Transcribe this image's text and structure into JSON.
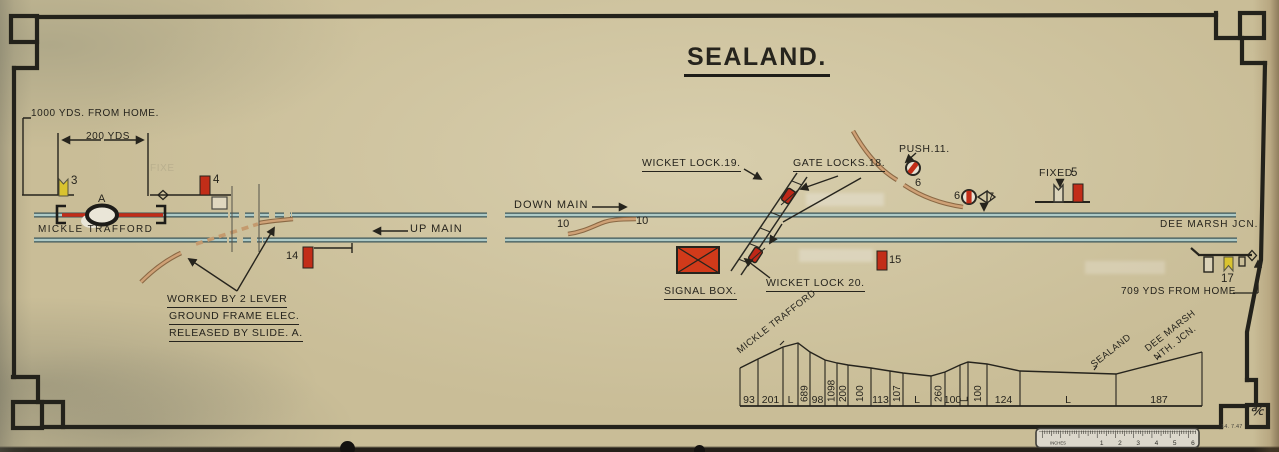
{
  "title": {
    "text": "SEALAND."
  },
  "labels": {
    "yds_1000": "1000 YDS. FROM HOME.",
    "yds_200": "200 YDS",
    "mickle_trafford": "MICKLE  TRAFFORD",
    "up_main": "UP MAIN",
    "down_main": "DOWN MAIN",
    "wicket_lock_19": "WICKET LOCK.19.",
    "gate_locks_18": "GATE LOCKS.18.",
    "push_11": "PUSH.11.",
    "fixed": "FIXED",
    "dee_marsh_jcn": "DEE  MARSH  JCN.",
    "signal_box": "SIGNAL BOX.",
    "wicket_lock_20": "WICKET LOCK 20.",
    "worked_line1": "WORKED  BY  2 LEVER",
    "worked_line2": "GROUND  FRAME  ELEC.",
    "worked_line3": "RELEASED  BY  SLIDE. A.",
    "yds_709": "709 YDS FROM  HOME",
    "ghost_fixe": "FIXE",
    "date_stamp": "14. 7.47",
    "corner_mark": "℀"
  },
  "numbers": {
    "n3": "3",
    "n4": "4",
    "n5": "5",
    "n6_curve": "6",
    "n6_disc": "6",
    "n7": "7",
    "n10_left": "10",
    "n10_right": "10",
    "n14": "14",
    "n15": "15",
    "n17": "17",
    "slide_a": "A"
  },
  "gradient_profile": {
    "baseline_y": 406,
    "boundaries": [
      [
        740,
        368
      ],
      [
        758,
        359
      ],
      [
        783,
        347
      ],
      [
        798,
        343
      ],
      [
        810,
        352
      ],
      [
        825,
        360
      ],
      [
        837,
        363
      ],
      [
        848,
        365
      ],
      [
        871,
        368
      ],
      [
        890,
        371
      ],
      [
        903,
        373
      ],
      [
        931,
        376
      ],
      [
        945,
        372
      ],
      [
        960,
        365
      ],
      [
        968,
        362
      ],
      [
        987,
        364
      ],
      [
        1020,
        371
      ],
      [
        1116,
        374
      ],
      [
        1202,
        352
      ]
    ],
    "segments": [
      {
        "label": "93",
        "vertical": false
      },
      {
        "label": "201",
        "vertical": false
      },
      {
        "label": "L",
        "vertical": false
      },
      {
        "label": "689",
        "vertical": true
      },
      {
        "label": "98",
        "vertical": false
      },
      {
        "label": "1098",
        "vertical": true
      },
      {
        "label": "200",
        "vertical": true
      },
      {
        "label": "100",
        "vertical": true
      },
      {
        "label": "113",
        "vertical": false
      },
      {
        "label": "107",
        "vertical": true
      },
      {
        "label": "L",
        "vertical": false
      },
      {
        "label": "260",
        "vertical": true
      },
      {
        "label": "100",
        "vertical": false
      },
      {
        "label": "L",
        "vertical": true
      },
      {
        "label": "100",
        "vertical": true
      },
      {
        "label": "124",
        "vertical": false
      },
      {
        "label": "L",
        "vertical": false
      },
      {
        "label": "187",
        "vertical": false
      }
    ],
    "station_labels": [
      {
        "text": "MICKLE TRAFFORD"
      },
      {
        "text": "SEALAND"
      },
      {
        "text": "DEE MARSH"
      },
      {
        "text": "NTH. JCN."
      }
    ]
  },
  "ruler": {
    "label": "INCHES",
    "numbers": [
      "1",
      "2",
      "3",
      "4",
      "5",
      "6"
    ]
  },
  "colors": {
    "paper": "#c9bd97",
    "ink": "#26241d",
    "red": "#c22d18",
    "yellow": "#d9c32f",
    "teal": "#aecac6",
    "teal_edge": "#3c5457",
    "tan": "#cfa176",
    "tan_edge": "#8a6844"
  }
}
